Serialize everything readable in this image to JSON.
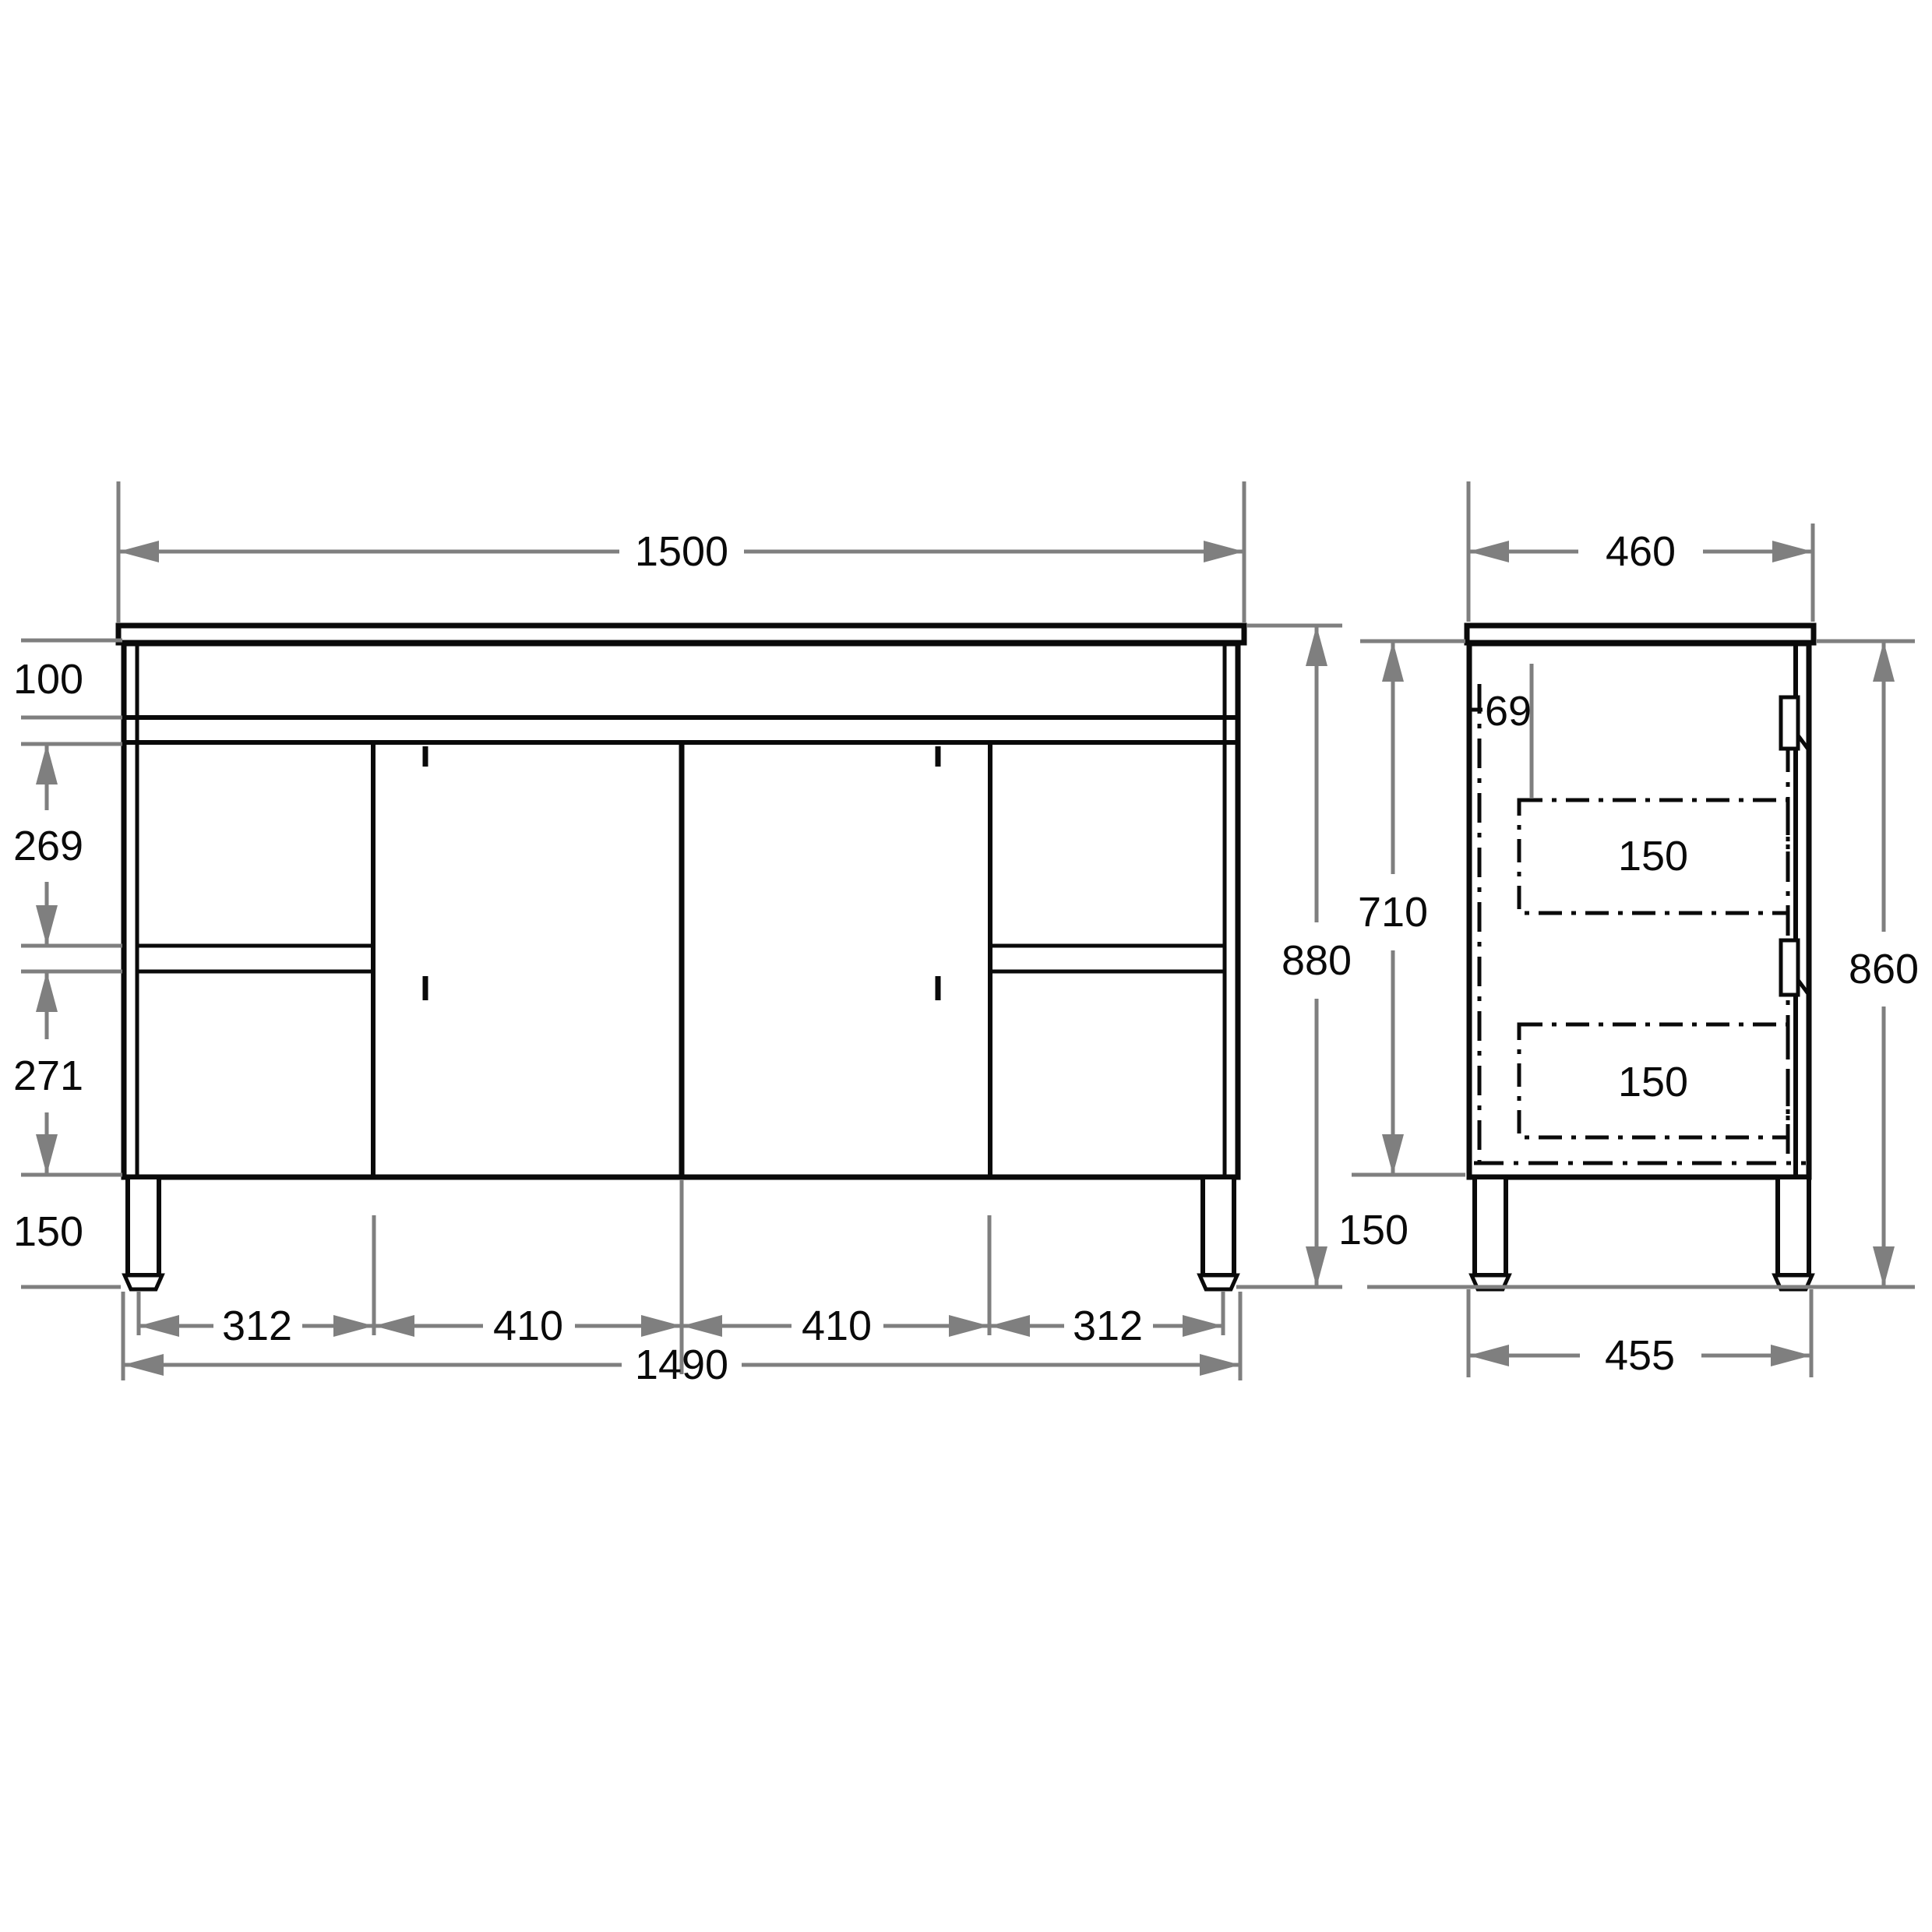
{
  "drawing": {
    "background_color": "#ffffff",
    "line_color": "#0a0a0a",
    "dimension_color": "#7f7f7f",
    "front_view": {
      "counter_width": "1500",
      "top_band_height": "100",
      "upper_drawer_height": "269",
      "lower_drawer_height": "271",
      "leg_height": "150",
      "overall_height": "880",
      "bottom_segments": [
        "312",
        "410",
        "410",
        "312"
      ],
      "cabinet_width": "1490"
    },
    "side_view": {
      "counter_depth": "460",
      "back_clearance": "69",
      "body_height": "710",
      "leg_height": "150",
      "height_under_counter": "860",
      "drawer_box_heights": [
        "150",
        "150"
      ],
      "leg_span_depth": "455"
    }
  }
}
